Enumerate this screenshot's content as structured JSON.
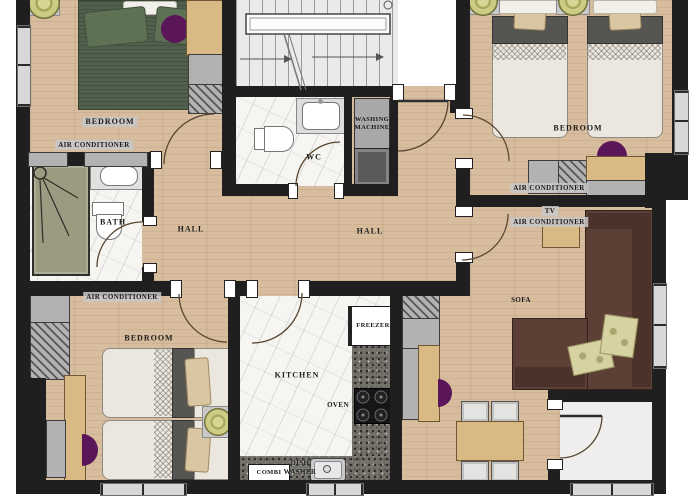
{
  "plan": {
    "type": "apartment-floor-plan",
    "colors": {
      "wall": "#1f1f1f",
      "wood": "#d7bd9e",
      "tan": "#d9ba84",
      "purple": "#5b165a",
      "accent": "#c8c77d"
    },
    "rooms": {
      "bedroom_top_left": {
        "name": "BEDROOM",
        "ac": "AIR CONDITIONER"
      },
      "bathroom": {
        "name": "BATH"
      },
      "hall_left": {
        "name": "HALL"
      },
      "wc": {
        "name": "WC"
      },
      "laundry": {
        "line1": "WASHING",
        "line2": "MACHINE"
      },
      "hall_main": {
        "name": "HALL"
      },
      "bedroom_top_right": {
        "name": "BEDROOM",
        "ac": "AIR CONDITIONER"
      },
      "living_room": {
        "tv": "TV",
        "ac": "AIR CONDITIONER",
        "sofa": "SOFA"
      },
      "bedroom_bottom_left": {
        "name": "BEDROOM",
        "ac": "AIR CONDITIONER"
      },
      "kitchen": {
        "name": "KITCHEN",
        "freezer": "FREEZER",
        "oven": "OVEN",
        "dishwasher_line1": "DISH",
        "dishwasher_line2": "WASHER",
        "combi": "COMBI"
      }
    }
  }
}
